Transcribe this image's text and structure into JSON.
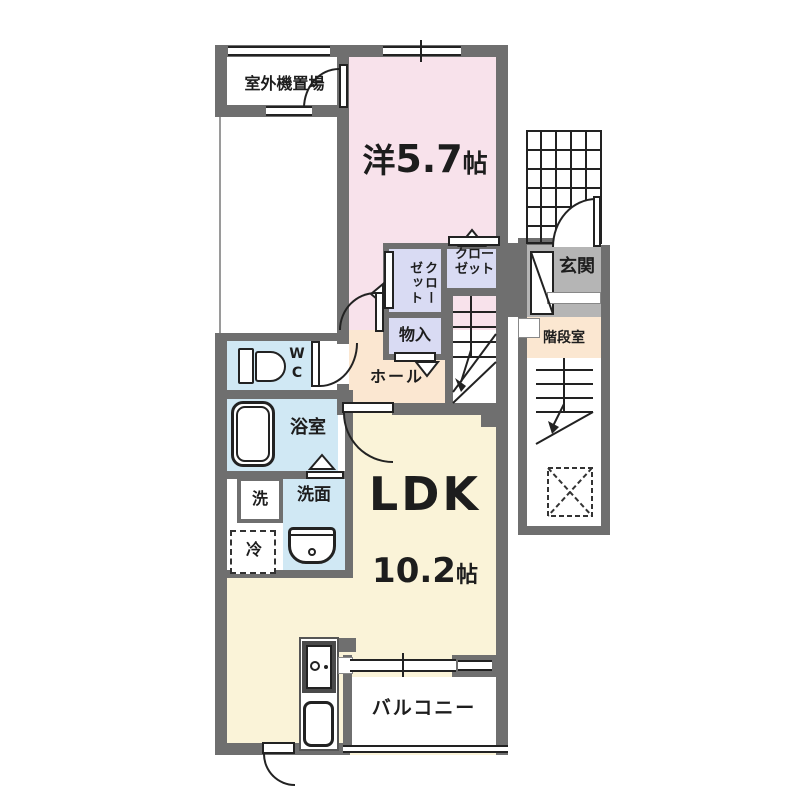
{
  "title": "floor-plan",
  "colors": {
    "wall": "#6f6f6f",
    "western_room_pink": "#f8e2eb",
    "ldk_cream": "#faf3d8",
    "hall_peach": "#fbe7d1",
    "closet_lavender": "#d9dbf3",
    "wet_area_blue": "#d0e8f4",
    "entrance_gray": "#b5b5b5",
    "line": "#222222"
  },
  "rooms": {
    "outdoor_unit": {
      "label": "室外機置場"
    },
    "western_room": {
      "name": "洋",
      "size": "5.7",
      "unit": "帖"
    },
    "closet_left": {
      "line1": "クロー",
      "line2": "ゼット"
    },
    "closet_right": {
      "line1": "クロー",
      "line2": "ゼット"
    },
    "storage": {
      "label": "物入"
    },
    "hall": {
      "label": "ホール"
    },
    "wc": {
      "label": "WC"
    },
    "bath": {
      "label": "浴室"
    },
    "washer": {
      "label": "洗"
    },
    "washroom": {
      "label": "洗面"
    },
    "fridge": {
      "label": "冷"
    },
    "ldk": {
      "name": "LDK",
      "size": "10.2",
      "unit": "帖"
    },
    "balcony": {
      "label": "バルコニー"
    },
    "entrance": {
      "label": "玄関"
    },
    "stairwell": {
      "label": "階段室"
    }
  }
}
